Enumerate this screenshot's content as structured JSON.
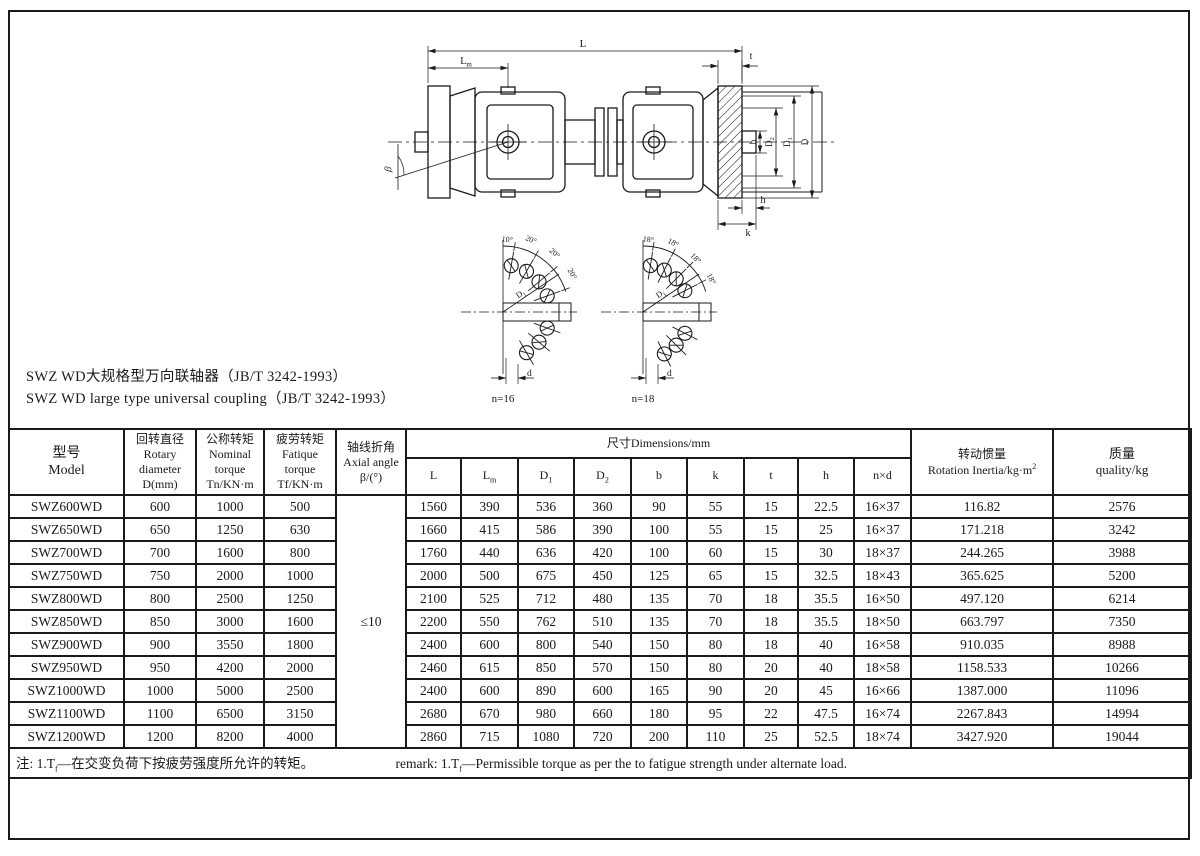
{
  "page": {
    "title_zh": "SWZ WD大规格型万向联轴器（JB/T 3242-1993）",
    "title_en": "SWZ WD large type universal coupling（JB/T 3242-1993）"
  },
  "drawing": {
    "labels": {
      "L": "L",
      "Lm_main": "L",
      "Lm_sub": "m",
      "t": "t",
      "beta": "β",
      "b": "b",
      "D2_main": "D",
      "D2_sub": "2",
      "D1_main": "D",
      "D1_sub": "1",
      "D": "D",
      "h": "h",
      "k": "k"
    },
    "bolt_views": [
      {
        "n_label": "n=16",
        "angle_top": "10°",
        "angle_1": "20°",
        "angle_2": "20°",
        "angle_3": "20°",
        "radius_main": "D",
        "radius_sub": "1",
        "d_label": "d"
      },
      {
        "n_label": "n=18",
        "angle_top": "18°",
        "angle_1": "18°",
        "angle_2": "18°",
        "angle_3": "18°",
        "radius_main": "D",
        "radius_sub": "1",
        "d_label": "d"
      }
    ]
  },
  "table": {
    "headers": {
      "model": "型号\nModel",
      "rotary_diameter": "回转直径\nRotary\ndiameter\nD(mm)",
      "nominal_torque": "公称转矩\nNominal\ntorque\nTn/KN·m",
      "fatigue_torque": "疲劳转矩\nFatique\ntorque\nTf/KN·m",
      "axial_angle": "轴线折角\nAxial angle\nβ/(°)",
      "dimensions": "尺寸Dimensions/mm",
      "dim_cols": [
        {
          "main": "L",
          "sub": ""
        },
        {
          "main": "L",
          "sub": "m"
        },
        {
          "main": "D",
          "sub": "1"
        },
        {
          "main": "D",
          "sub": "2"
        },
        {
          "main": "b",
          "sub": ""
        },
        {
          "main": "k",
          "sub": ""
        },
        {
          "main": "t",
          "sub": ""
        },
        {
          "main": "h",
          "sub": ""
        },
        {
          "main": "n×d",
          "sub": ""
        }
      ],
      "inertia_zh": "转动惯量",
      "inertia_en": "Rotation Inertia/kg·m",
      "inertia_sup": "2",
      "quality": "质量\nquality/kg"
    },
    "axial_angle_value": "≤10",
    "row_fields": [
      "model",
      "rotary-diameter",
      "nominal-torque",
      "fatigue-torque",
      "L",
      "Lm",
      "D1",
      "D2",
      "b",
      "k",
      "t",
      "h",
      "nxd",
      "inertia",
      "quality"
    ],
    "rows": [
      [
        "SWZ600WD",
        "600",
        "1000",
        "500",
        "1560",
        "390",
        "536",
        "360",
        "90",
        "55",
        "15",
        "22.5",
        "16×37",
        "116.82",
        "2576"
      ],
      [
        "SWZ650WD",
        "650",
        "1250",
        "630",
        "1660",
        "415",
        "586",
        "390",
        "100",
        "55",
        "15",
        "25",
        "16×37",
        "171.218",
        "3242"
      ],
      [
        "SWZ700WD",
        "700",
        "1600",
        "800",
        "1760",
        "440",
        "636",
        "420",
        "100",
        "60",
        "15",
        "30",
        "18×37",
        "244.265",
        "3988"
      ],
      [
        "SWZ750WD",
        "750",
        "2000",
        "1000",
        "2000",
        "500",
        "675",
        "450",
        "125",
        "65",
        "15",
        "32.5",
        "18×43",
        "365.625",
        "5200"
      ],
      [
        "SWZ800WD",
        "800",
        "2500",
        "1250",
        "2100",
        "525",
        "712",
        "480",
        "135",
        "70",
        "18",
        "35.5",
        "16×50",
        "497.120",
        "6214"
      ],
      [
        "SWZ850WD",
        "850",
        "3000",
        "1600",
        "2200",
        "550",
        "762",
        "510",
        "135",
        "70",
        "18",
        "35.5",
        "18×50",
        "663.797",
        "7350"
      ],
      [
        "SWZ900WD",
        "900",
        "3550",
        "1800",
        "2400",
        "600",
        "800",
        "540",
        "150",
        "80",
        "18",
        "40",
        "16×58",
        "910.035",
        "8988"
      ],
      [
        "SWZ950WD",
        "950",
        "4200",
        "2000",
        "2460",
        "615",
        "850",
        "570",
        "150",
        "80",
        "20",
        "40",
        "18×58",
        "1158.533",
        "10266"
      ],
      [
        "SWZ1000WD",
        "1000",
        "5000",
        "2500",
        "2400",
        "600",
        "890",
        "600",
        "165",
        "90",
        "20",
        "45",
        "16×66",
        "1387.000",
        "11096"
      ],
      [
        "SWZ1100WD",
        "1100",
        "6500",
        "3150",
        "2680",
        "670",
        "980",
        "660",
        "180",
        "95",
        "22",
        "47.5",
        "16×74",
        "2267.843",
        "14994"
      ],
      [
        "SWZ1200WD",
        "1200",
        "8200",
        "4000",
        "2860",
        "715",
        "1080",
        "720",
        "200",
        "110",
        "25",
        "52.5",
        "18×74",
        "3427.920",
        "19044"
      ]
    ],
    "note": {
      "zh_pre": "注: 1.T",
      "zh_sub": "f",
      "zh_post": "—在交变负荷下按疲劳强度所允许的转矩。",
      "en_pre": "remark: 1.T",
      "en_sub": "f",
      "en_post": "—Permissible torque as per the to fatigue strength under alternate load."
    }
  }
}
